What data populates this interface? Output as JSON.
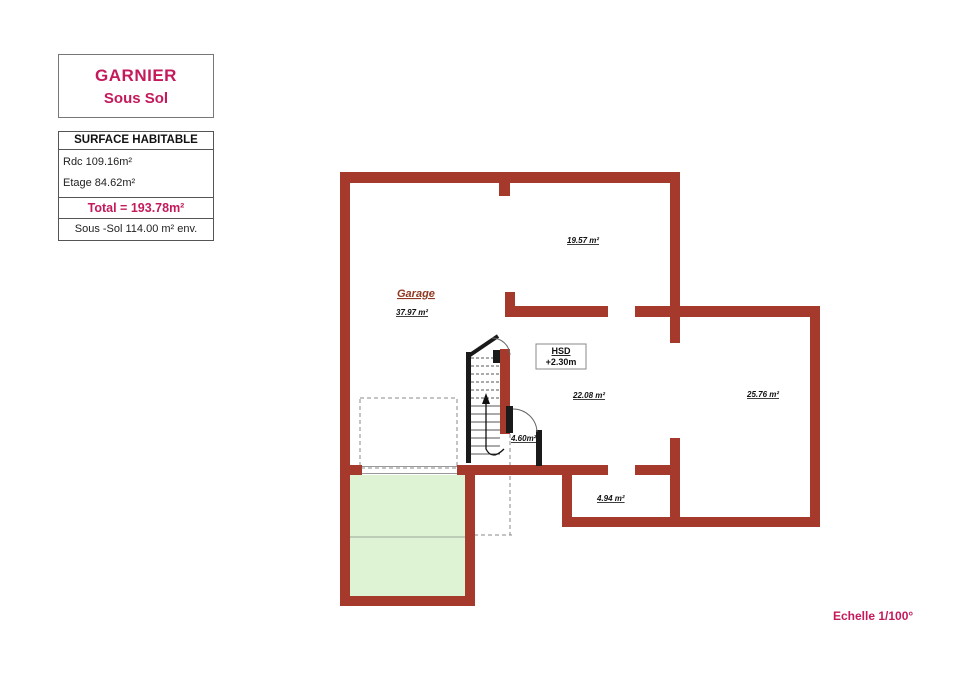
{
  "title_block": {
    "client": "GARNIER",
    "level": "Sous Sol"
  },
  "surface_table": {
    "header": "SURFACE HABITABLE",
    "rows": [
      "Rdc 109.16m²",
      "Etage 84.62m²"
    ],
    "total": "Total = 193.78m²",
    "footer": "Sous -Sol 114.00 m² env."
  },
  "plan": {
    "garage_label": "Garage",
    "areas": {
      "garage": "37.97 m²",
      "room_top": "19.57 m²",
      "room_center": "22.08 m²",
      "room_right": "25.76 m²",
      "stairwell": "4.60m²",
      "hall": "4.94 m²"
    },
    "hsd": {
      "line1": "HSD",
      "line2": "+2.30m"
    },
    "colors": {
      "wall": "#a5392b",
      "accent_text": "#c41a5b",
      "garage_text": "#8f3922",
      "terrace_fill": "#def3d4",
      "stair_wall": "#1a1a1a"
    }
  },
  "scale_note": "Echelle 1/100°"
}
